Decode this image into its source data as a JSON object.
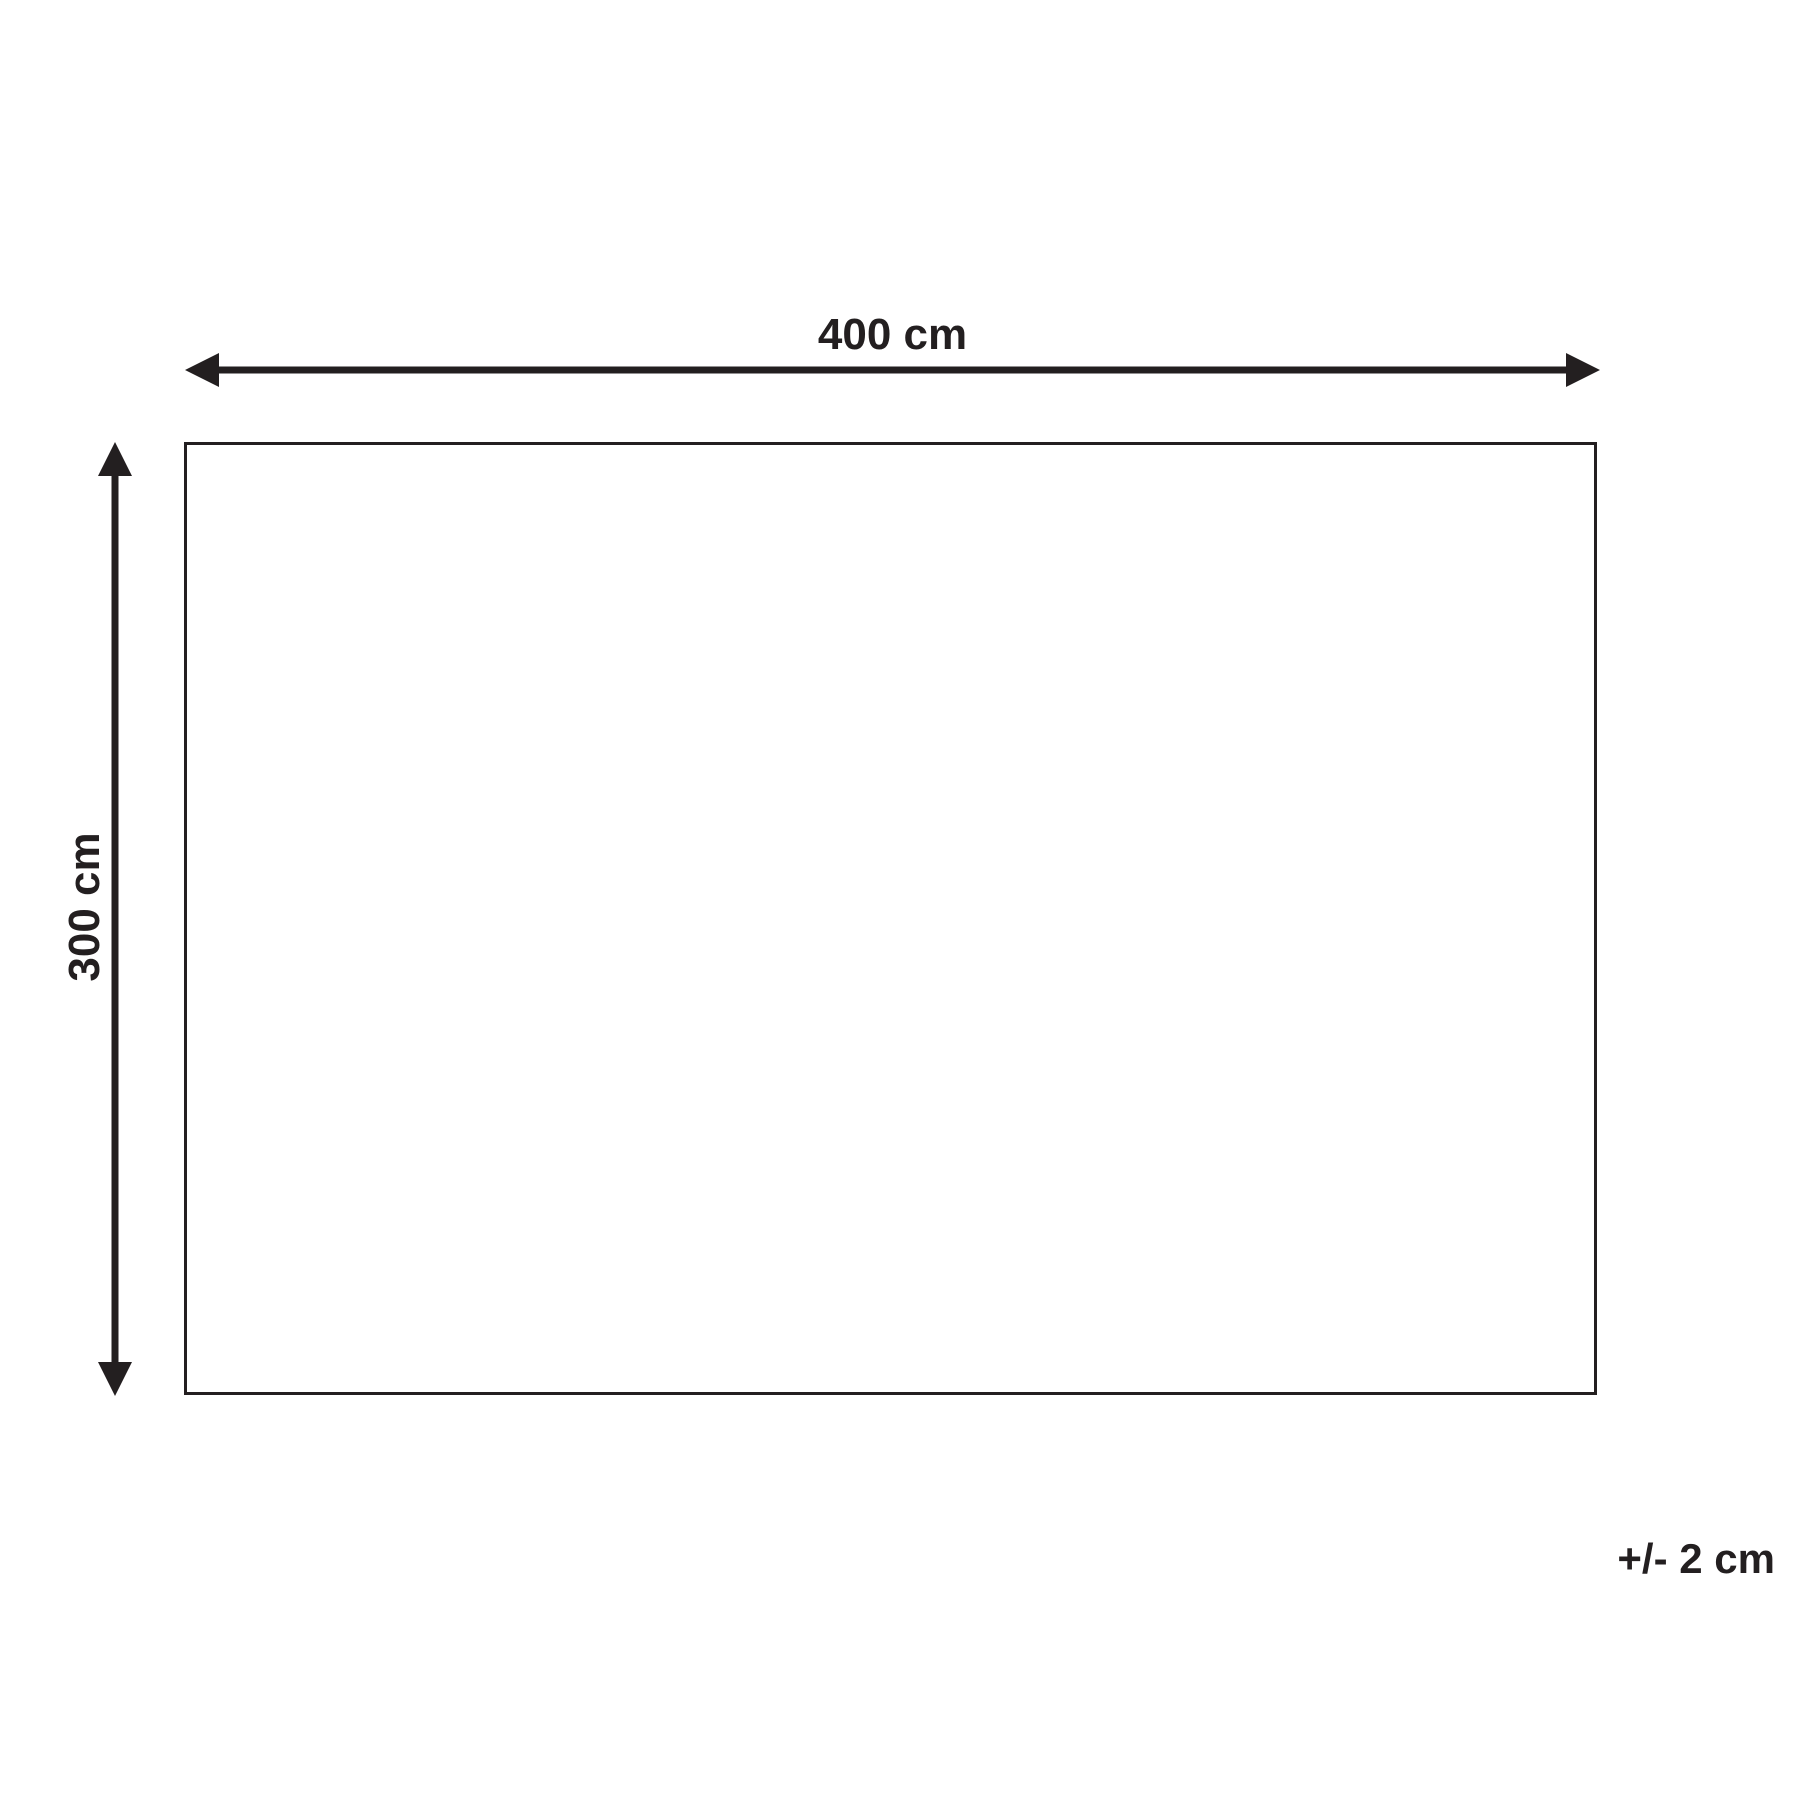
{
  "diagram": {
    "type": "product-dimension-diagram",
    "width_label": "400 cm",
    "height_label": "300 cm",
    "tolerance_label": "+/- 2 cm",
    "line_color": "#231f20",
    "background_color": "#ffffff",
    "shape": "rectangle"
  }
}
